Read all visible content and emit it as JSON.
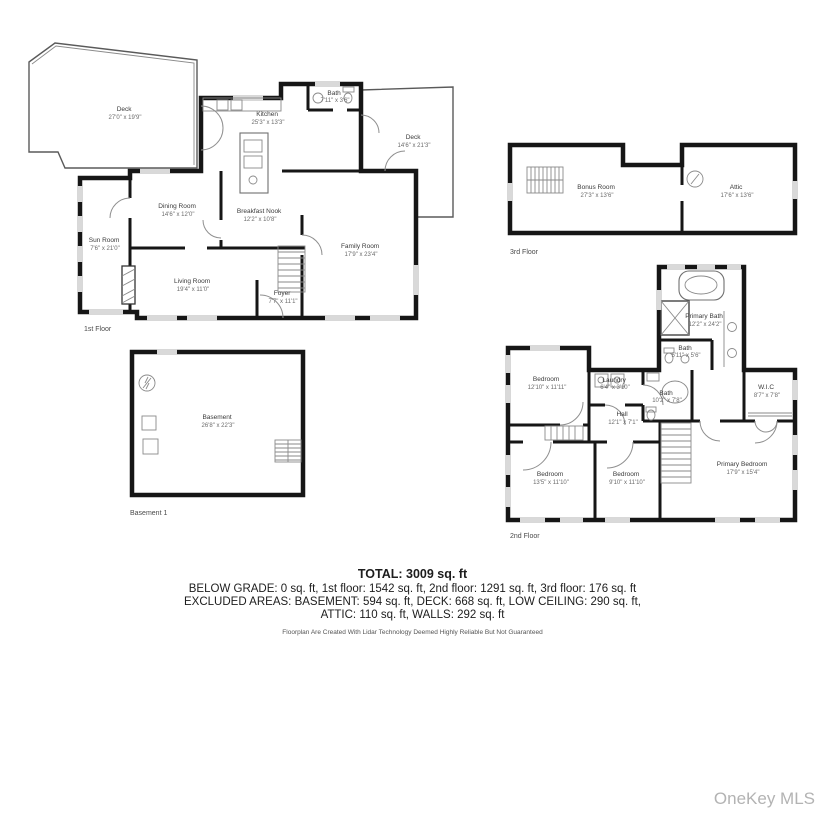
{
  "floors": {
    "first": {
      "label": "1st Floor",
      "rooms": {
        "deck_left": {
          "name": "Deck",
          "dims": "27'0\" x 19'9\""
        },
        "kitchen": {
          "name": "Kitchen",
          "dims": "25'3\" x 13'3\""
        },
        "bath": {
          "name": "Bath",
          "dims": "7'11\" x 3'6\""
        },
        "deck_right": {
          "name": "Deck",
          "dims": "14'6\" x 21'3\""
        },
        "dining_room": {
          "name": "Dining Room",
          "dims": "14'6\" x 12'0\""
        },
        "breakfast_nook": {
          "name": "Breakfast Nook",
          "dims": "12'2\" x 10'8\""
        },
        "sun_room": {
          "name": "Sun Room",
          "dims": "7'6\" x 21'0\""
        },
        "family_room": {
          "name": "Family Room",
          "dims": "17'9\" x 23'4\""
        },
        "living_room": {
          "name": "Living Room",
          "dims": "19'4\" x 11'0\""
        },
        "foyer": {
          "name": "Foyer",
          "dims": "7'7\" x 11'1\""
        }
      }
    },
    "third": {
      "label": "3rd Floor",
      "rooms": {
        "bonus_room": {
          "name": "Bonus Room",
          "dims": "27'3\" x 13'6\""
        },
        "attic": {
          "name": "Attic",
          "dims": "17'6\" x 13'6\""
        }
      }
    },
    "basement": {
      "label": "Basement 1",
      "rooms": {
        "basement": {
          "name": "Basement",
          "dims": "26'8\" x 22'3\""
        }
      }
    },
    "second": {
      "label": "2nd Floor",
      "rooms": {
        "primary_bath": {
          "name": "Primary Bath",
          "dims": "12'2\" x 24'2\""
        },
        "bath_small": {
          "name": "Bath",
          "dims": "5'11\" x 5'6\""
        },
        "bath": {
          "name": "Bath",
          "dims": "10'2\" x 7'8\""
        },
        "wic": {
          "name": "W.I.C",
          "dims": "8'7\" x 7'8\""
        },
        "laundry": {
          "name": "Laundry",
          "dims": "6'4\" x 3'10\""
        },
        "bedroom_left": {
          "name": "Bedroom",
          "dims": "12'10\" x 11'11\""
        },
        "hall": {
          "name": "Hall",
          "dims": "12'1\" x 7'1\""
        },
        "bedroom_bl": {
          "name": "Bedroom",
          "dims": "13'5\" x 11'10\""
        },
        "bedroom_bm": {
          "name": "Bedroom",
          "dims": "9'10\" x 11'10\""
        },
        "primary_bedroom": {
          "name": "Primary Bedroom",
          "dims": "17'9\" x 15'4\""
        }
      }
    }
  },
  "summary": {
    "total": "TOTAL: 3009 sq. ft",
    "line1": "BELOW GRADE: 0 sq. ft, 1st floor: 1542 sq. ft, 2nd floor: 1291 sq. ft, 3rd floor: 176 sq. ft",
    "line2": "EXCLUDED AREAS: BASEMENT: 594 sq. ft, DECK: 668 sq. ft, LOW CEILING: 290 sq. ft,",
    "line3": "ATTIC: 110 sq. ft, WALLS: 292 sq. ft",
    "disclaimer": "Floorplan Are Created With Lidar Technology Deemed Highly Reliable But Not Guaranteed"
  },
  "watermark": "OneKey MLS"
}
